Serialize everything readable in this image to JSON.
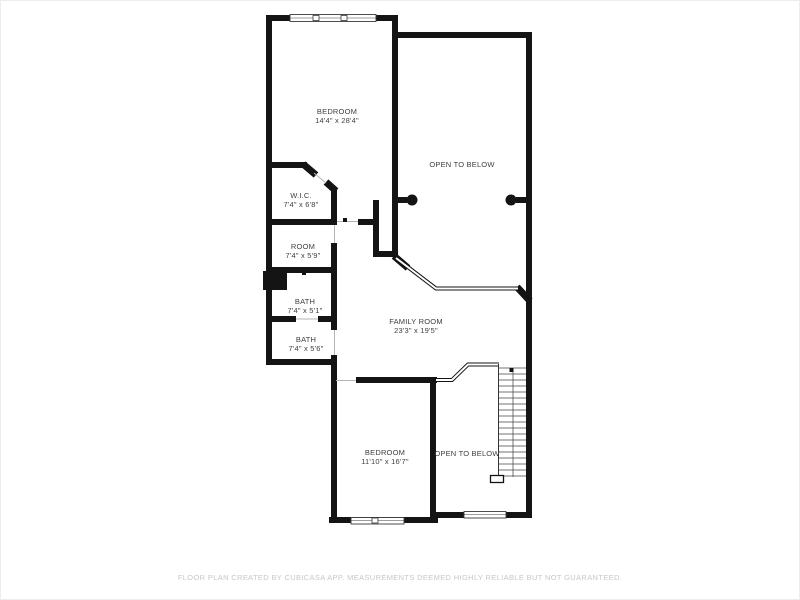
{
  "plan": {
    "background": "#ffffff",
    "wall_color": "#141414",
    "label_color": "#3f3f3f",
    "footer_color": "#c7c7c7"
  },
  "rooms": [
    {
      "name": "BEDROOM",
      "dims": "14'4\" x 28'4\""
    },
    {
      "name": "OPEN TO BELOW",
      "dims": ""
    },
    {
      "name": "W.I.C.",
      "dims": "7'4\" x 6'8\""
    },
    {
      "name": "ROOM",
      "dims": "7'4\" x 5'9\""
    },
    {
      "name": "BATH",
      "dims": "7'4\" x 5'1\""
    },
    {
      "name": "BATH",
      "dims": "7'4\" x 5'6\""
    },
    {
      "name": "FAMILY ROOM",
      "dims": "23'3\" x 19'5\""
    },
    {
      "name": "BEDROOM",
      "dims": "11'10\" x 16'7\""
    },
    {
      "name": "OPEN TO BELOW",
      "dims": ""
    }
  ],
  "footer": {
    "text": "FLOOR PLAN CREATED BY CUBICASA APP. MEASUREMENTS DEEMED HIGHLY RELIABLE BUT NOT GUARANTEED."
  }
}
